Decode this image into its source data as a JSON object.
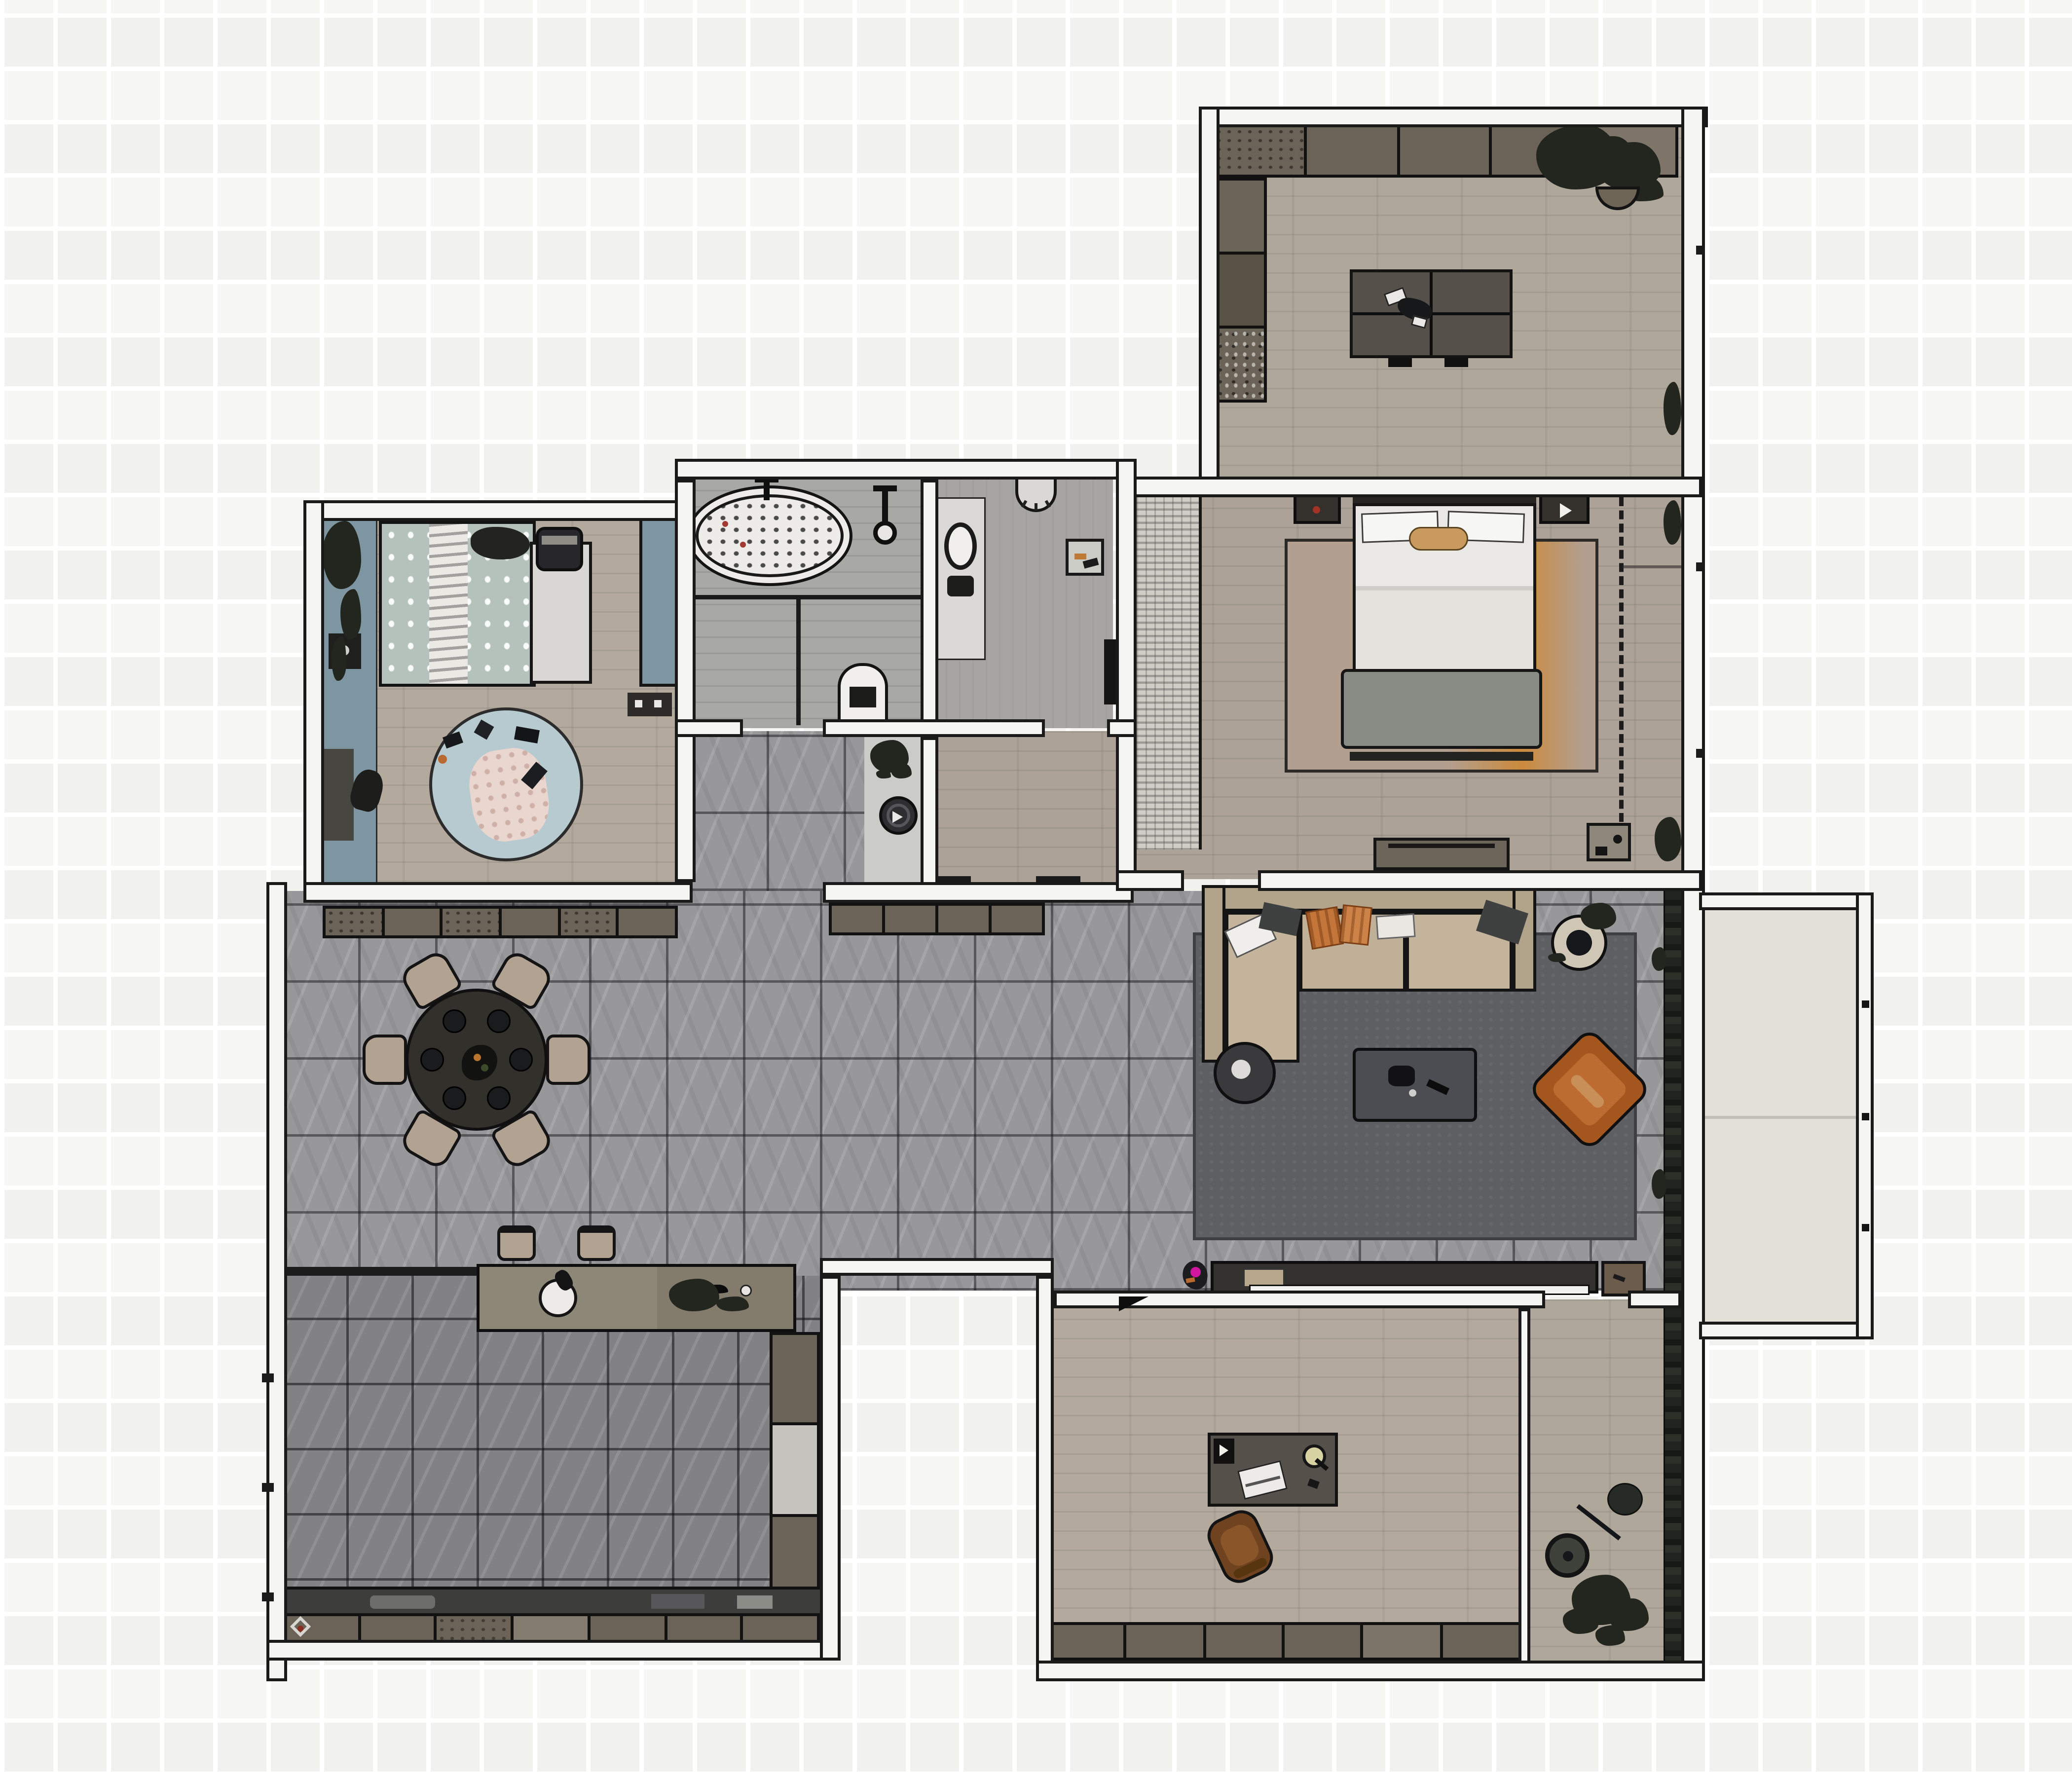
{
  "title": "furnished-apartment-floor-plan",
  "palette": {
    "bg": "#f6f6f3",
    "bg_line": "#ffffff",
    "wall_fill": "#f5f5f1",
    "wall_line": "#1a1a1a",
    "wood_a": "#b0a79b",
    "wood_b": "#aca297",
    "wood_c": "#b3a99d",
    "tile_light": "#98989b",
    "tile_dark": "#828284",
    "bath_floor": "#a8a8a4",
    "wc_floor": "#a6a5a1",
    "nook_floor": "#cbcbc7",
    "balcony_floor": "#e2e1d8",
    "wardrobe_tex": "#d0cdc7",
    "cabinet": "#6b6357",
    "cabinet_dark": "#585145",
    "cabinet_light": "#7e7568",
    "counter_dark": "#3d3d3b",
    "rug_living": "#5e5f62",
    "rug_bed": "#b29f90",
    "rug_bed_accent": "#cc8a3c",
    "rug_kids": "#b6cad0",
    "sofa": "#b2a48b",
    "sofa_seat": "#c4b49b",
    "armchair": "#a4561f",
    "armchair_seat": "#bd6c31",
    "orange": "#c4763a",
    "magenta": "#d016a0",
    "bed_white": "#e9e8e4",
    "bench": "#878c84",
    "kids_accent": "#7d96a1",
    "kids_bedding": "#b5c1bb",
    "plant": "#22261f",
    "table_dark": "#32302b",
    "chair_tan": "#b2a291",
    "desk": "#55504a",
    "chair_brown": "#6f4220",
    "vacuum": "#2e2e30",
    "fixture_light": "#ecebe7",
    "appliance": "#f0efeb",
    "tv": "#f1f1ef",
    "console": "#33312e"
  },
  "counts": {
    "study_cabinet_segments": 5,
    "study_side_segments": 3,
    "sideboard_a_segments": 6,
    "sideboard_b_segments": 4,
    "kitchen_tall_segments": 3,
    "kitchen_base_segments": 7,
    "office_base_segments": 6,
    "dining_chairs": 6,
    "dining_plates": 6,
    "bar_stools": 2,
    "balcony_posts": 3
  },
  "rooms": [
    {
      "id": "study",
      "semantic": "study-hobby-room",
      "floor": "wood",
      "furniture": [
        "wall-cabinet-row",
        "tall-cabinet-column",
        "craft-table",
        "corner-plant",
        "basket"
      ]
    },
    {
      "id": "master-bedroom",
      "semantic": "master-bedroom",
      "floor": "wood",
      "furniture": [
        "double-bed",
        "pillows",
        "bed-bench",
        "area-rug",
        "nightstand-left",
        "nightstand-right",
        "wardrobe-strip",
        "dresser-tv-unit",
        "closet-dashed-zone",
        "corner-unit",
        "plants"
      ]
    },
    {
      "id": "bathroom",
      "semantic": "bathroom",
      "floor": "wood-tile",
      "furniture": [
        "bathtub",
        "tub-faucet",
        "shower-head",
        "glass-partition",
        "water-heater"
      ]
    },
    {
      "id": "wc",
      "semantic": "wc-laundry",
      "floor": "tile",
      "furniture": [
        "vanity-sink",
        "toilet",
        "floor-drain",
        "door-leaf"
      ]
    },
    {
      "id": "kids-bedroom",
      "semantic": "kids-bedroom",
      "floor": "wood",
      "furniture": [
        "single-bed",
        "polka-dot-bedding",
        "dark-pillow",
        "toy-basket",
        "wardrobe",
        "side-panel",
        "desk",
        "desk-chair",
        "side-table",
        "round-rug",
        "play-blanket",
        "toys"
      ]
    },
    {
      "id": "hallway",
      "semantic": "hallway-nook",
      "floor": "tile",
      "furniture": [
        "potted-plant",
        "robot-vacuum",
        "thresholds"
      ]
    },
    {
      "id": "dining",
      "semantic": "dining-area",
      "floor": "tile",
      "furniture": [
        "round-dining-table",
        "dining-chairs",
        "centerpiece",
        "sideboard-a",
        "sideboard-b",
        "bar-stools"
      ]
    },
    {
      "id": "kitchen",
      "semantic": "kitchen",
      "floor": "tile",
      "furniture": [
        "island-counter",
        "sink",
        "cooktop-items",
        "counter-strip",
        "base-cabinet-row",
        "tall-cabinet-column",
        "window-ticks"
      ]
    },
    {
      "id": "living",
      "semantic": "living-room",
      "floor": "tile",
      "furniture": [
        "corner-sofa",
        "chaise",
        "throw-pillows",
        "round-side-table",
        "coffee-table",
        "armchair",
        "area-rug",
        "tv-console",
        "tv",
        "potted-plant",
        "magenta-item",
        "side-table",
        "window-plants"
      ]
    },
    {
      "id": "office",
      "semantic": "home-office",
      "floor": "wood",
      "furniture": [
        "desk",
        "desk-lamp",
        "laptop",
        "speaker",
        "desk-chair",
        "base-cabinet-row",
        "entry-door-wedge"
      ]
    },
    {
      "id": "corridor",
      "semantic": "corridor",
      "floor": "wood",
      "furniture": [
        "tall-plant",
        "watering-can",
        "window-plants"
      ]
    },
    {
      "id": "balcony",
      "semantic": "balcony",
      "floor": "concrete",
      "furniture": [
        "railing",
        "railing-posts"
      ]
    }
  ]
}
